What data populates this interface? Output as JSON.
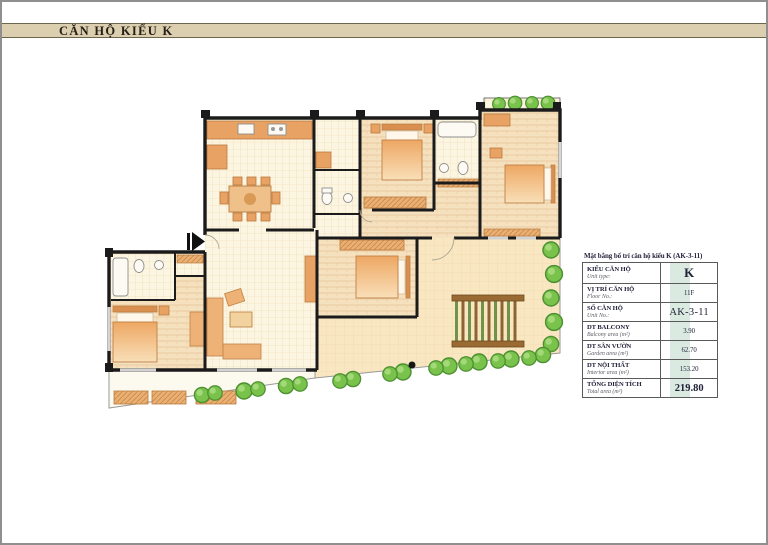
{
  "header": {
    "title": "CĂN HỘ KIỂU K"
  },
  "info_table": {
    "caption": "Mặt bằng bố trí căn hộ kiểu K (AK-3-11)",
    "rows": [
      {
        "label": "KIỂU CĂN HỘ",
        "sublabel": "Unit type:",
        "value": "K",
        "size": "xl"
      },
      {
        "label": "VỊ TRÍ CĂN HỘ",
        "sublabel": "Floor No.:",
        "value": "11F",
        "size": "sm"
      },
      {
        "label": "SỐ CĂN HỘ",
        "sublabel": "Unit No.:",
        "value": "AK-3-11",
        "size": "lg"
      },
      {
        "label": "DT BALCONY",
        "sublabel": "Balcony area (m²)",
        "value": "3.90",
        "size": "sm"
      },
      {
        "label": "DT SÂN VƯỜN",
        "sublabel": "Garden area (m²)",
        "value": "62.70",
        "size": "sm"
      },
      {
        "label": "DT NỘI THẤT",
        "sublabel": "Interior area (m²)",
        "value": "153.20",
        "size": "sm"
      },
      {
        "label": "TỔNG DIỆN TÍCH",
        "sublabel": "Total area (m²)",
        "value": "219.80",
        "size": "bold"
      }
    ]
  },
  "colors": {
    "band": "#dbcfb0",
    "wall": "#1b1b1b",
    "bush": "#79c24c",
    "bush_dark": "#4c9030",
    "furniture": "#e8a263",
    "table_highlight": "#bcd8c6",
    "ink": "#21213a"
  }
}
